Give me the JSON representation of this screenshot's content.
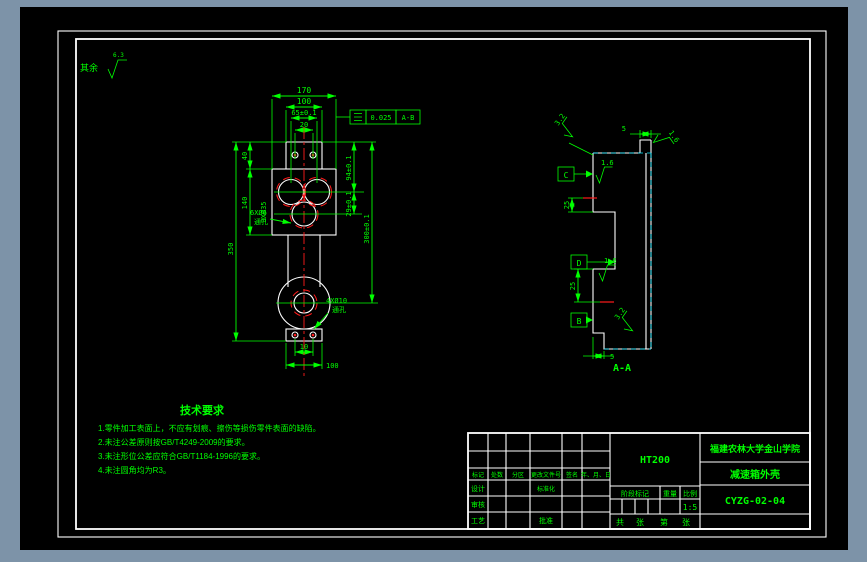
{
  "colors": {
    "background": "#7d93a8",
    "canvas": "#000000",
    "line_green": "#00ff00",
    "line_white": "#ffffff",
    "line_red": "#ff1a1a",
    "line_cyan": "#00e5ff"
  },
  "general_note": {
    "prefix": "其余",
    "value": "6.3"
  },
  "front_view": {
    "dims": {
      "width_total": "170",
      "width_100": "100",
      "width_65": "65±0.1",
      "width_20": "20",
      "h40": "40",
      "h140": "140",
      "h350": "350",
      "r94": "94±0.1",
      "r29": "29±0.1",
      "r300": "300±0.1",
      "b10": "10",
      "b100": "100"
    },
    "labels": {
      "holes_35": "3XØ35",
      "holes_6_line1": "6XØ6",
      "holes_6_line2": "通孔",
      "holes_10_line1": "4XØ10",
      "holes_10_line2": "通孔"
    },
    "gtol": {
      "value": "0.025",
      "datum": "A-B"
    }
  },
  "side_view": {
    "roughness": {
      "top_left": "3.2",
      "top_right": "1.6",
      "mid": "1.6",
      "lower": "1.6",
      "bottom": "3.2"
    },
    "datums": {
      "c": "C",
      "d": "D",
      "b": "B"
    },
    "dims": {
      "top5": "5",
      "mid25": "25",
      "low25": "25",
      "bottom5": "5"
    },
    "section_label": "A-A"
  },
  "tech_requirements": {
    "title": "技术要求",
    "lines": [
      "1.零件加工表面上，不应有划痕、擦伤等损伤零件表面的缺陷。",
      "2.未注公差原则按GB/T4249-2009的要求。",
      "3.未注形位公差应符合GB/T1184-1996的要求。",
      "4.未注圆角均为R3。"
    ]
  },
  "title_block": {
    "material": "HT200",
    "school": "福建农林大学金山学院",
    "part_name": "减速箱外壳",
    "drawing_no": "CYZG-02-04",
    "scale_value": "1:5",
    "headers": {
      "mark": "标记",
      "count": "处数",
      "zone": "分区",
      "change_file": "更改文件号",
      "sign": "签名",
      "date": "年、月、日",
      "design": "设计",
      "standardize": "标准化",
      "check": "审核",
      "process": "工艺",
      "approve": "批准",
      "stage": "阶段标记",
      "weight": "重量",
      "scale": "比例",
      "total": "共",
      "sheet1": "张",
      "page": "第",
      "sheet2": "张"
    }
  }
}
